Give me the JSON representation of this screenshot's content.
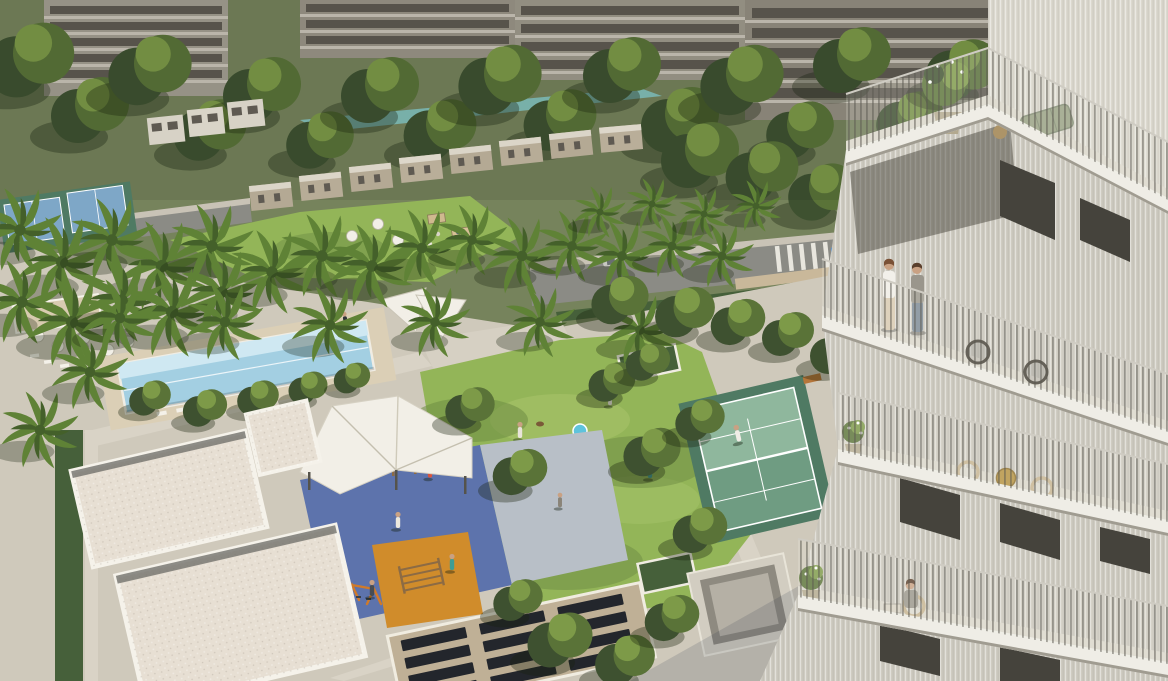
{
  "scene": {
    "type": "aerial-architectural-render",
    "description": "Aerial dusk-free daylight rendering of a residential community: foreground amenity courtyard with lap pool, white shade sails, lawn, paddle-tennis court, calisthenics playground with blue and orange surfacing, white clubhouse roofs and a slatted pergola; palm-lined road with two cars; rows of townhouses, a turquoise lagoon and mid-rise apartment blocks behind dense trees; at right a white ribbed residential tower with planted balconies, outdoor furniture and residents.",
    "elements": [
      "background apartment blocks",
      "tree canopy band",
      "lagoon pool",
      "townhouse row",
      "white villas",
      "palm-lined road",
      "blue car",
      "silver car",
      "crosswalk",
      "tennis courts (blue)",
      "cabana and umbrella deck",
      "lap pool with loungers",
      "shade sails",
      "event lawn with market stalls and umbrellas",
      "central lawn with residents and dog",
      "kiddie pool",
      "tree planters",
      "paddle court with player and bench",
      "fitness canopy",
      "calisthenics frames",
      "orange play mat",
      "swing frames",
      "clubhouse gravel roofs",
      "hedge rows",
      "slatted pergola roof",
      "concrete water feature",
      "balcony tower",
      "roof terrace with potted tree and green sofa",
      "couple talking on balcony",
      "wicker chairs",
      "gold bistro table",
      "seated resident on lower balcony",
      "flowering balcony pots",
      "vertical-bar railings"
    ],
    "people_visible": "residents on lawn, paths, court, playground and three balconies",
    "colors": {
      "base": "#76835c",
      "bg_bldg_a": "#a5a094",
      "bg_bldg_b": "#9c968a",
      "bg_bldg_c": "#a19b8e",
      "bg_bldg_d": "#968f83",
      "bg_window": "#5f5a52",
      "bg_slab": "#cdc7bb",
      "tree_dark": "#3e5130",
      "tree_mid": "#5a7338",
      "tree_light": "#7d9a48",
      "palm_frond": "#5f8236",
      "palm_core": "#44602a",
      "trunk": "#8b7355",
      "lagoon": "#84c1ba",
      "lawn": "#93b558",
      "lawn_light": "#a6c369",
      "lawn_shadow": "#6d8c44",
      "hedge": "#46603a",
      "road": "#8b8b85",
      "sidewalk": "#c9c3b6",
      "path": "#d9d3c6",
      "deck": "#cfc9bb",
      "plaza": "#d6d0c3",
      "wall_tan": "#c9b89a",
      "pool_water": "#a3cfe2",
      "pool_light": "#cfe8f2",
      "pool_deck": "#dbcfb6",
      "court_blue": "#7ea7c7",
      "court_green": "#6f9c82",
      "court_green_light": "#8fb79d",
      "court_surround": "#4f7a63",
      "bench": "#b5763a",
      "play_blue": "#5d73ac",
      "play_paving": "#b8bfc7",
      "play_orange": "#d08c2b",
      "wood": "#8c6b44",
      "bar_yellow": "#e0aa3e",
      "bar_blue": "#3f6ed0",
      "swing_orange": "#d07a2a",
      "roof_gravel": "#e7dfd3",
      "parapet": "#f5f2ea",
      "roof_gutter": "#73726d",
      "pergola_wood": "#bfb096",
      "pergola_slot": "#23262c",
      "canopy_white": "#f2efe7",
      "tower_face": "#cfccc2",
      "tower_face_sun": "#dcd9cf",
      "tower_wall": "#c9c5ba",
      "tower_slab": "#efede6",
      "tower_slab_shadow": "#a09c91",
      "tower_floor": "#dcd8cd",
      "window_dark": "#45433c",
      "rail_top": "#cfccc3",
      "railing_bar": "#5a584f",
      "sofa_green": "#97a083",
      "table_wood": "#ad9468",
      "table_gold": "#b5913f",
      "wicker": "#c7b491",
      "wicker_dark": "#443f36",
      "pot": "#b3a98f",
      "skin": "#c9a183",
      "hair_dark": "#5a3f2c",
      "hair_brown": "#7a5136",
      "shirt_white": "#f2f0ea",
      "shirt_gray": "#9a968c",
      "jeans": "#7b8896",
      "skirt": "#d9cbb2",
      "car_blue": "#2f7fd6",
      "car_silver": "#c8c8c2",
      "kiddie_pool": "#5ec3dc",
      "feature_concrete": "#d2cdc1",
      "feature_inner": "#8e8a80"
    }
  }
}
